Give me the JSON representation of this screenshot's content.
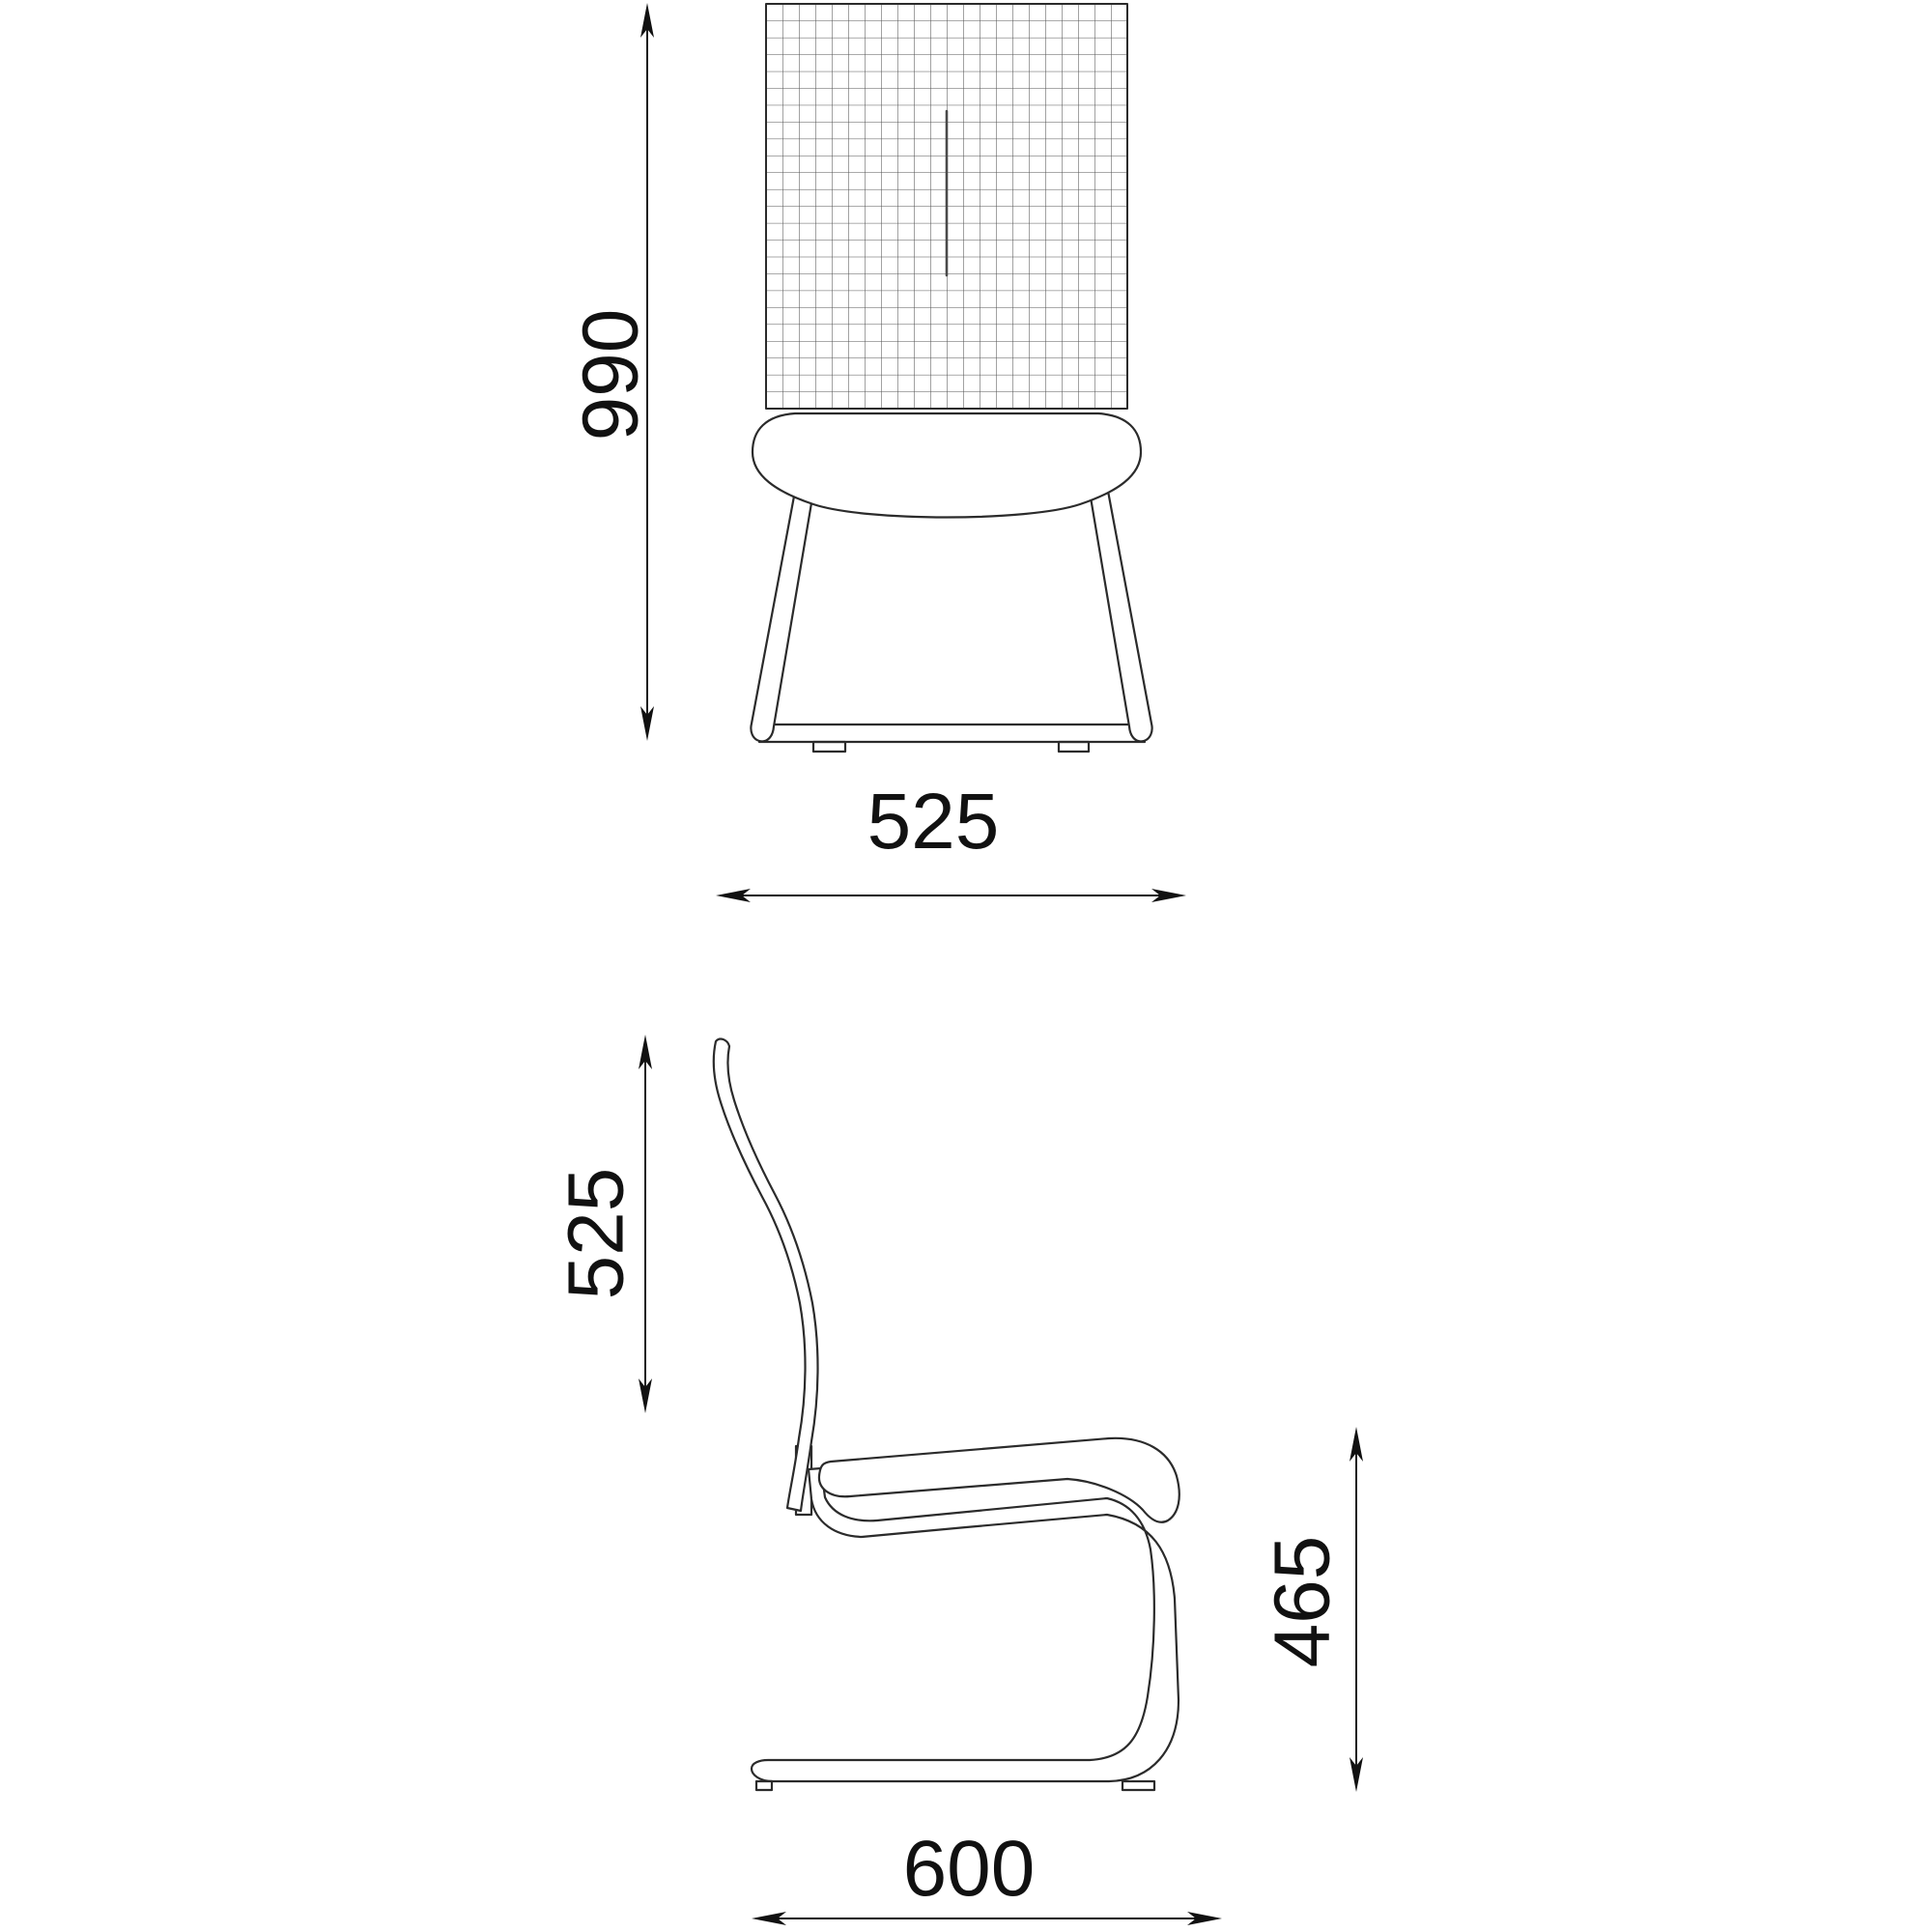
{
  "page": {
    "background": "#ffffff"
  },
  "drawing": {
    "type": "technical-dimension-drawing",
    "subject": "chair",
    "stroke_color": "#2b2b2b",
    "grid_color": "#555555",
    "seam_color": "#4a4a4a",
    "dim_color": "#111111",
    "fill_color": "#ffffff",
    "views": {
      "front": {
        "height_dim": {
          "label": "990"
        },
        "width_dim": {
          "label": "525"
        }
      },
      "side": {
        "back_height_dim": {
          "label": "525"
        },
        "seat_height_dim": {
          "label": "465"
        },
        "depth_dim": {
          "label": "600"
        }
      }
    }
  }
}
